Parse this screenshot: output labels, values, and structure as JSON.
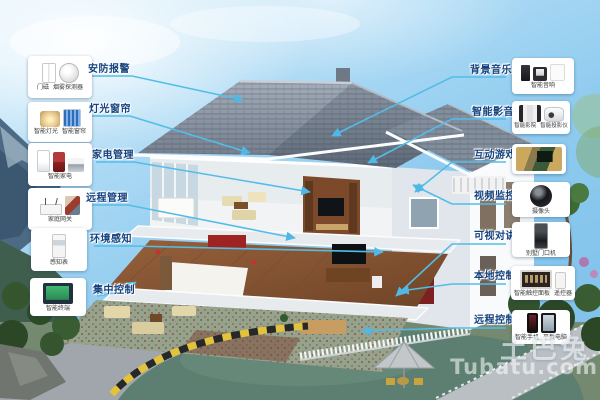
{
  "watermark": {
    "logo_text": "土巴兔",
    "site_text": "Tubatu.com"
  },
  "left_annotations": [
    {
      "label": "安防报警",
      "products": [
        {
          "name": "门磁",
          "icon": "door-sensor"
        },
        {
          "name": "烟雾探测器",
          "icon": "smoke-detector"
        }
      ]
    },
    {
      "label": "灯光窗帘",
      "products": [
        {
          "name": "智能灯光",
          "icon": "ceiling-light"
        },
        {
          "name": "智能窗帘",
          "icon": "curtain"
        }
      ]
    },
    {
      "label": "家电管理",
      "products": [
        {
          "name": "智能家电",
          "icon": "appliances"
        }
      ]
    },
    {
      "label": "远程管理",
      "products": [
        {
          "name": "家庭网关",
          "icon": "gateway-router"
        }
      ]
    },
    {
      "label": "环境感知",
      "products": [
        {
          "name": "感知表",
          "icon": "sensor-meter"
        }
      ]
    },
    {
      "label": "集中控制",
      "products": [
        {
          "name": "智能终端",
          "icon": "touch-terminal"
        }
      ]
    }
  ],
  "right_annotations": [
    {
      "label": "背景音乐",
      "products": [
        {
          "name": "智能音响",
          "icon": "speaker-system"
        }
      ]
    },
    {
      "label": "智能影音",
      "products": [
        {
          "name": "智能影院",
          "icon": "home-cinema"
        },
        {
          "name": "智能投影仪",
          "icon": "projector"
        }
      ]
    },
    {
      "label": "互动游戏",
      "products": []
    },
    {
      "label": "视频监控",
      "products": [
        {
          "name": "摄像头",
          "icon": "dome-camera"
        }
      ]
    },
    {
      "label": "可视对讲",
      "products": [
        {
          "name": "别墅门口机",
          "icon": "door-station"
        }
      ]
    },
    {
      "label": "本地控制",
      "products": [
        {
          "name": "智能触控面板",
          "icon": "touch-panel"
        },
        {
          "name": "遥控器",
          "icon": "remote-control"
        }
      ]
    },
    {
      "label": "远程控制",
      "products": [
        {
          "name": "智能手机",
          "icon": "smartphone"
        },
        {
          "name": "平板电脑",
          "icon": "tablet"
        }
      ]
    }
  ],
  "colors": {
    "callout_line": "#53bce8",
    "label_text": "#14427e",
    "card_bg": "#ffffff",
    "sky": "#8fcbef",
    "roof": "#8a94a2",
    "watermark": "rgba(255,255,255,0.6)"
  }
}
